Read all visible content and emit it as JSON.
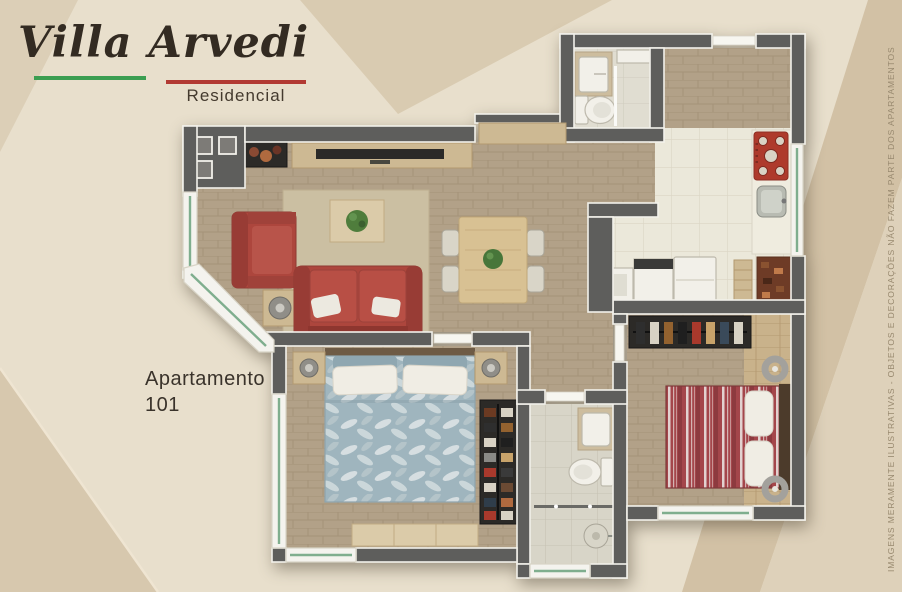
{
  "brand": {
    "title": "Villa Arvedi",
    "subtitle": "Residencial"
  },
  "unit": {
    "line1": "Apartamento",
    "line2": "101"
  },
  "disclaimer": "IMAGENS MERAMENTE ILUSTRATIVAS - OBJETOS E DECORAÇÕES NÃO FAZEM PARTE DOS APARTAMENTOS",
  "colors": {
    "bg": "#e8dfcc",
    "bgTL": "#dccfb7",
    "bgTC": "#d9cbb1",
    "bgTR": "#d2c1a5",
    "bgR": "#ded1ba",
    "bgBL": "#d7c8ae",
    "wall": "#5e5e5c",
    "trim": "#f2f1ea",
    "glassGreen": "#7fae8e",
    "logoGreen": "#3b9e51",
    "logoRed": "#b23a33",
    "textDark": "#332b22",
    "textMuted": "#98896f",
    "sofaRed": "#ad463d",
    "stoveRed": "#ae3a2c",
    "bedBlue": "#9fb5be",
    "bedRed": "#a4464b",
    "floorWood": "#b2a188",
    "floorWhiteTile": "#ebe8da",
    "floorGrayTile": "#d8d5c8"
  }
}
